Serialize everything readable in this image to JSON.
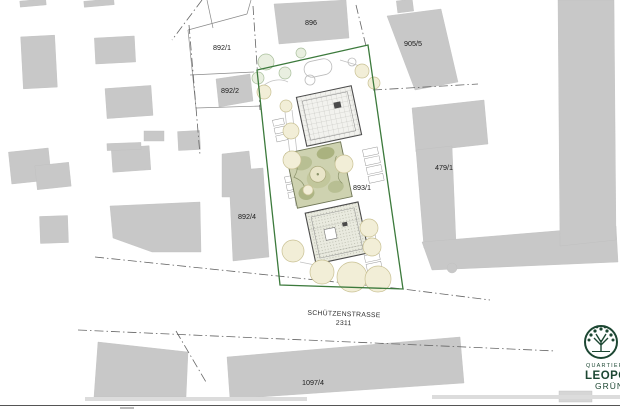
{
  "plan": {
    "street_label": {
      "name": "SCHÜTZENSTRASSE",
      "number": "2311"
    },
    "parcel_labels": {
      "p896": "896",
      "p892_1": "892/1",
      "p892_2": "892/2",
      "p892_4": "892/4",
      "p905_5": "905/5",
      "p479_1": "479/1",
      "p893_1": "893/1",
      "p1097_4": "1097/4"
    }
  },
  "logo": {
    "top": "QUARTIER",
    "middle": "LEOPOLD",
    "bottom": "GRÜN"
  },
  "colors": {
    "site_boundary_green": "#3c7a3c",
    "context_building_grey": "#c8c8c8",
    "logo_green": "#1d4733",
    "tree_fill_beige": "#f2eed7",
    "tree_fill_pale_green": "#e9efe0",
    "garden_olive": "#ced2b0"
  }
}
